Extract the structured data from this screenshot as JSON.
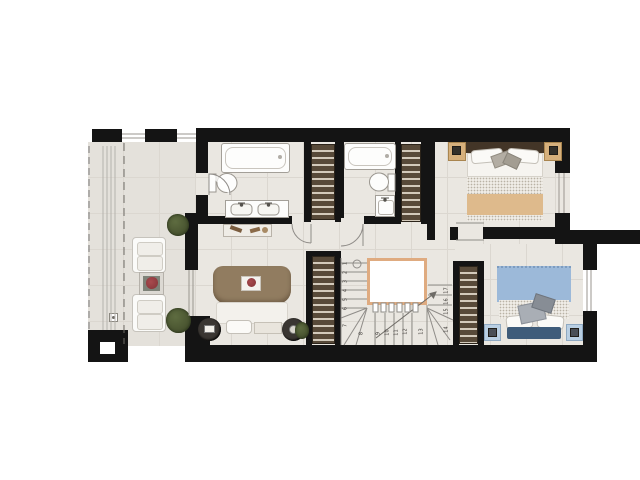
{
  "plan": {
    "stair_steps": [
      "1",
      "2",
      "3",
      "4",
      "5",
      "6",
      "7",
      "8",
      "9",
      "10",
      "11",
      "12",
      "13",
      "14",
      "15",
      "16",
      "17"
    ]
  },
  "colors": {
    "wall": "#141414",
    "floor_interior": "#eae7e1",
    "floor_terrace": "#e4e1db",
    "tile_line": "#dbd7d0",
    "wardrobe": "#584a39",
    "wardrobe_rail": "#d3cabb",
    "fixture": "#fdfdfc",
    "outline": "#a39f98",
    "bed1_blanket": "#deba8c",
    "bed1_headboard": "#433527",
    "bed1_nightstand": "#d6b07c",
    "bed2_throw": "#917c60",
    "bed2_nightstand": "#3a3632",
    "bed3_blanket": "#9cb9d9",
    "bed3_bench": "#3f5c7a",
    "bed3_nightstand": "#b9cfe3",
    "plant_green": "#4a5531",
    "plant_red": "#8e3a3e",
    "void_border": "#dfab80",
    "stair_line": "#8f8c88"
  },
  "furniture": {
    "terrace": [
      "armchair",
      "armchair",
      "side-table",
      "flower-pot",
      "bush",
      "bush",
      "wall-light"
    ],
    "bathroom_1": [
      "shower-tub",
      "toilet",
      "double-vanity-sink"
    ],
    "bathroom_2": [
      "shower-tub",
      "toilet",
      "sink"
    ],
    "hallway": [
      "wardrobe",
      "wardrobe",
      "console-table",
      "plant"
    ],
    "bedroom_top_right": [
      "double-bed",
      "headboard",
      "nightstand",
      "nightstand",
      "table-lamp",
      "table-lamp"
    ],
    "bedroom_bottom_left": [
      "double-bed",
      "throw-blanket",
      "nightstand",
      "nightstand",
      "bench"
    ],
    "bedroom_bottom_right": [
      "double-bed",
      "headboard-bench",
      "nightstand",
      "nightstand",
      "wardrobe"
    ],
    "stairs": [
      "staircase",
      "stairwell-void",
      "balusters",
      "direction-arrow"
    ]
  }
}
